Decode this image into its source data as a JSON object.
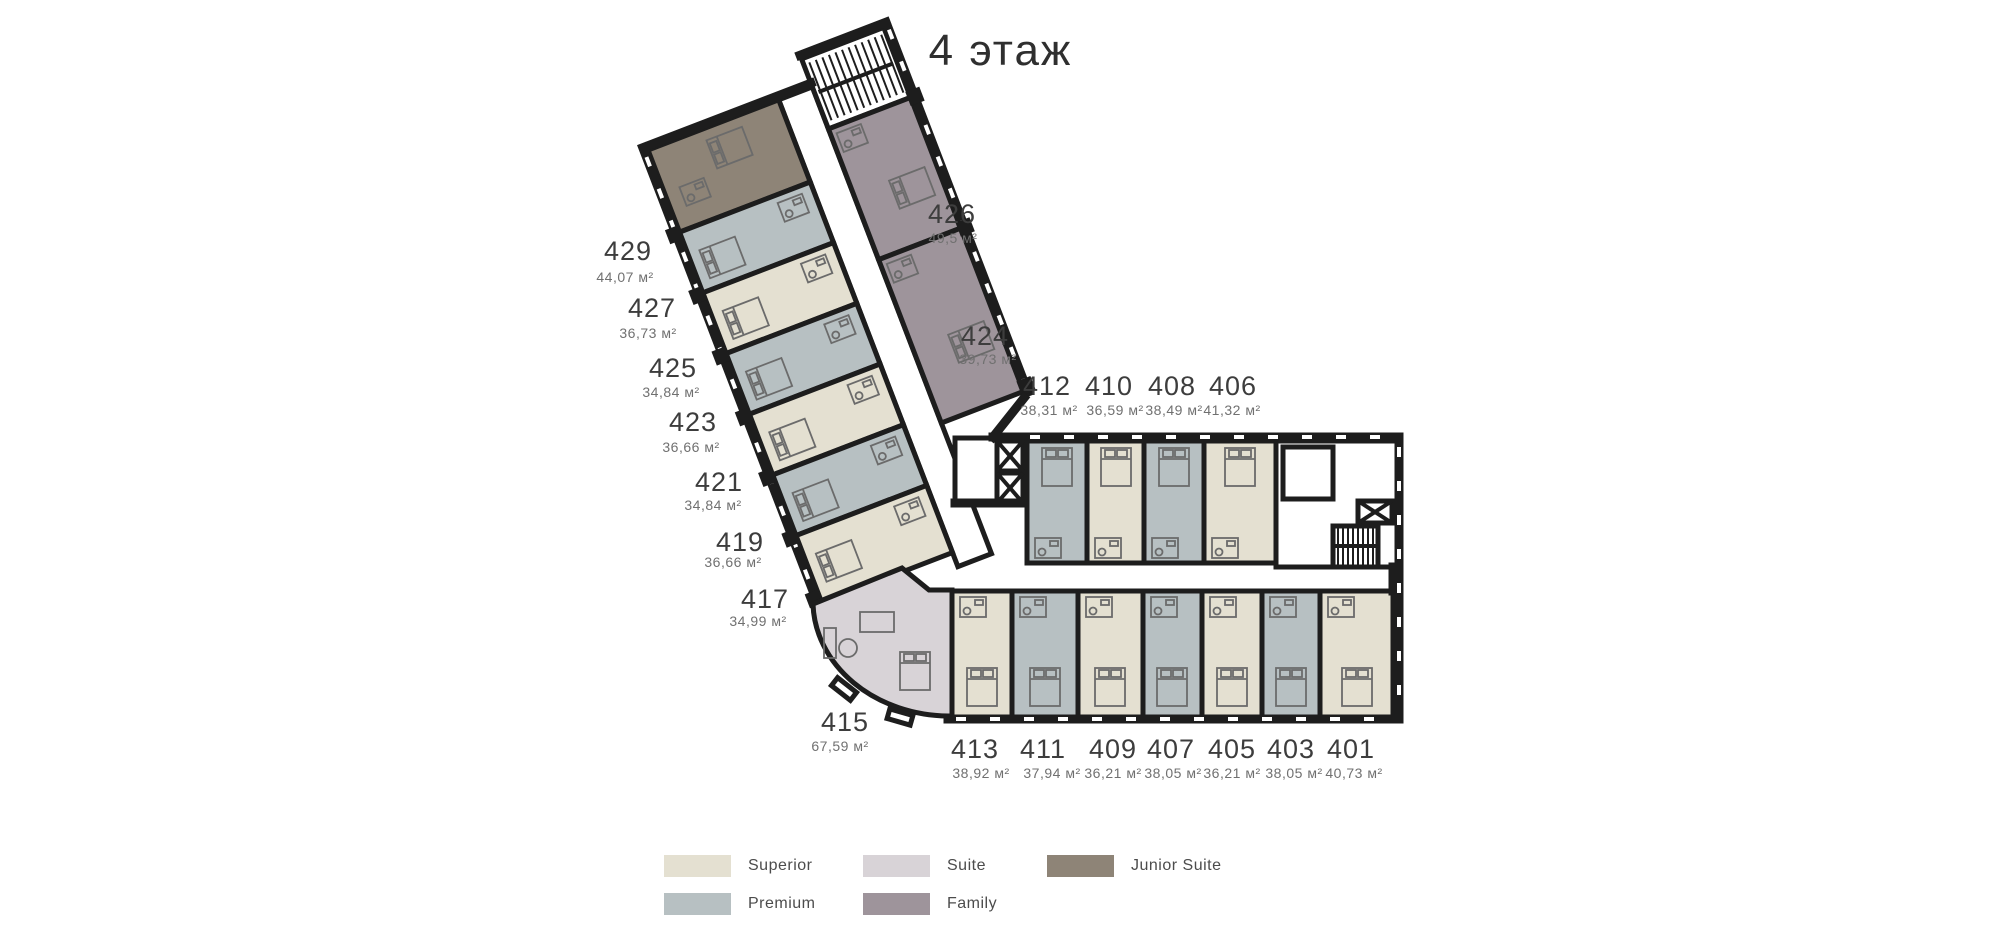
{
  "title": "4 этаж",
  "colors": {
    "superior": "#e4e0d1",
    "premium": "#b7c0c2",
    "suite": "#d8d3d7",
    "family": "#9e949b",
    "junior_suite": "#8e8477",
    "wall": "#1d1d1d",
    "furniture": "#6b6b6b"
  },
  "legend": [
    {
      "label": "Superior",
      "color": "#e4e0d1"
    },
    {
      "label": "Suite",
      "color": "#d8d3d7"
    },
    {
      "label": "Junior Suite",
      "color": "#8e8477"
    },
    {
      "label": "Premium",
      "color": "#b7c0c2"
    },
    {
      "label": "Family",
      "color": "#9e949b"
    }
  ],
  "rooms": [
    {
      "number": "429",
      "area": "44,07 м²",
      "type": "junior_suite"
    },
    {
      "number": "427",
      "area": "36,73 м²",
      "type": "premium"
    },
    {
      "number": "425",
      "area": "34,84 м²",
      "type": "superior"
    },
    {
      "number": "423",
      "area": "36,66 м²",
      "type": "premium"
    },
    {
      "number": "421",
      "area": "34,84 м²",
      "type": "superior"
    },
    {
      "number": "419",
      "area": "36,66 м²",
      "type": "premium"
    },
    {
      "number": "417",
      "area": "34,99 м²",
      "type": "superior"
    },
    {
      "number": "415",
      "area": "67,59 м²",
      "type": "suite"
    },
    {
      "number": "426",
      "area": "49,5 м²",
      "type": "family"
    },
    {
      "number": "424",
      "area": "39,73 м²",
      "type": "family"
    },
    {
      "number": "412",
      "area": "38,31 м²",
      "type": "premium"
    },
    {
      "number": "410",
      "area": "36,59 м²",
      "type": "superior"
    },
    {
      "number": "408",
      "area": "38,49 м²",
      "type": "premium"
    },
    {
      "number": "406",
      "area": "41,32 м²",
      "type": "superior"
    },
    {
      "number": "413",
      "area": "38,92 м²",
      "type": "superior"
    },
    {
      "number": "411",
      "area": "37,94 м²",
      "type": "premium"
    },
    {
      "number": "409",
      "area": "36,21 м²",
      "type": "superior"
    },
    {
      "number": "407",
      "area": "38,05 м²",
      "type": "premium"
    },
    {
      "number": "405",
      "area": "36,21 м²",
      "type": "superior"
    },
    {
      "number": "403",
      "area": "38,05 м²",
      "type": "premium"
    },
    {
      "number": "401",
      "area": "40,73 м²",
      "type": "superior"
    }
  ]
}
